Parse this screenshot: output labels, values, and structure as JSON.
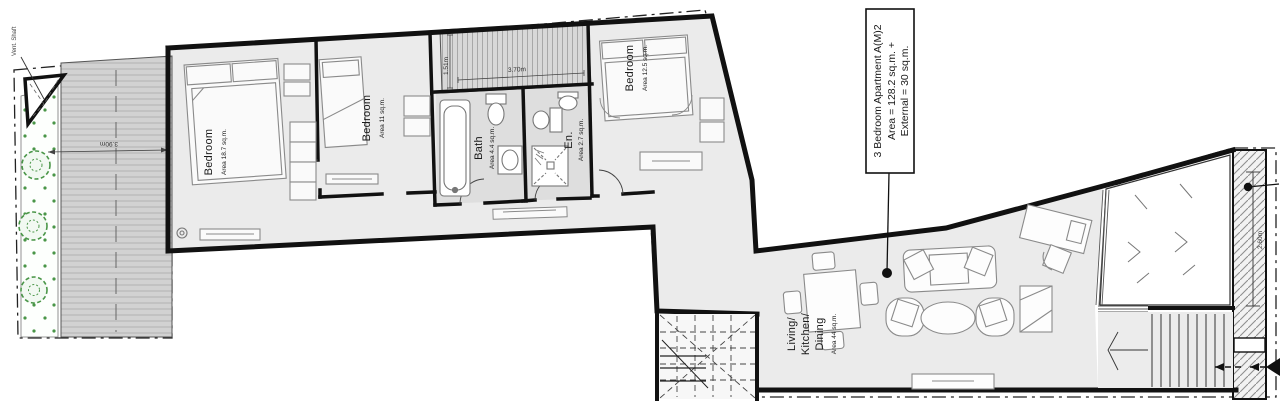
{
  "callout": {
    "line1": "3 Bedroom Apartment  A(M)2",
    "line2": "Area = 128.2 sq.m. +",
    "line3": "External = 30 sq.m."
  },
  "rooms": {
    "bedroom1": {
      "name": "Bedroom",
      "area": "Area 18.7 sq.m."
    },
    "bedroom2": {
      "name": "Bedroom",
      "area": "Area 11 sq.m."
    },
    "bath": {
      "name": "Bath",
      "area": "Area 4.4 sq.m."
    },
    "ensuite": {
      "name": "En.",
      "area": "Area 2.7 sq.m."
    },
    "bedroom3": {
      "name": "Bedroom",
      "area": "Area 12.5 sq.m."
    },
    "living": {
      "line1": "Living/",
      "line2": "Kitchen/",
      "line3": "Dining",
      "area": "Area 44 sq.m."
    }
  },
  "labels": {
    "vent_shaft": "Vent. Shaft"
  },
  "dimensions": {
    "terrace_depth": "1.51m",
    "terrace_width": "3.70m",
    "deck_width": "3.90m",
    "lightwell_depth": "2.60m"
  },
  "colors": {
    "wall": "#111111",
    "floor": "#ebebeb",
    "wet_floor": "#dedede",
    "deck": "#d2d2d2",
    "terrace": "#d6d6d6",
    "hatch": "#8f8f8f",
    "plant_green": "#4a9648",
    "annotation": "#1a1a1a"
  }
}
